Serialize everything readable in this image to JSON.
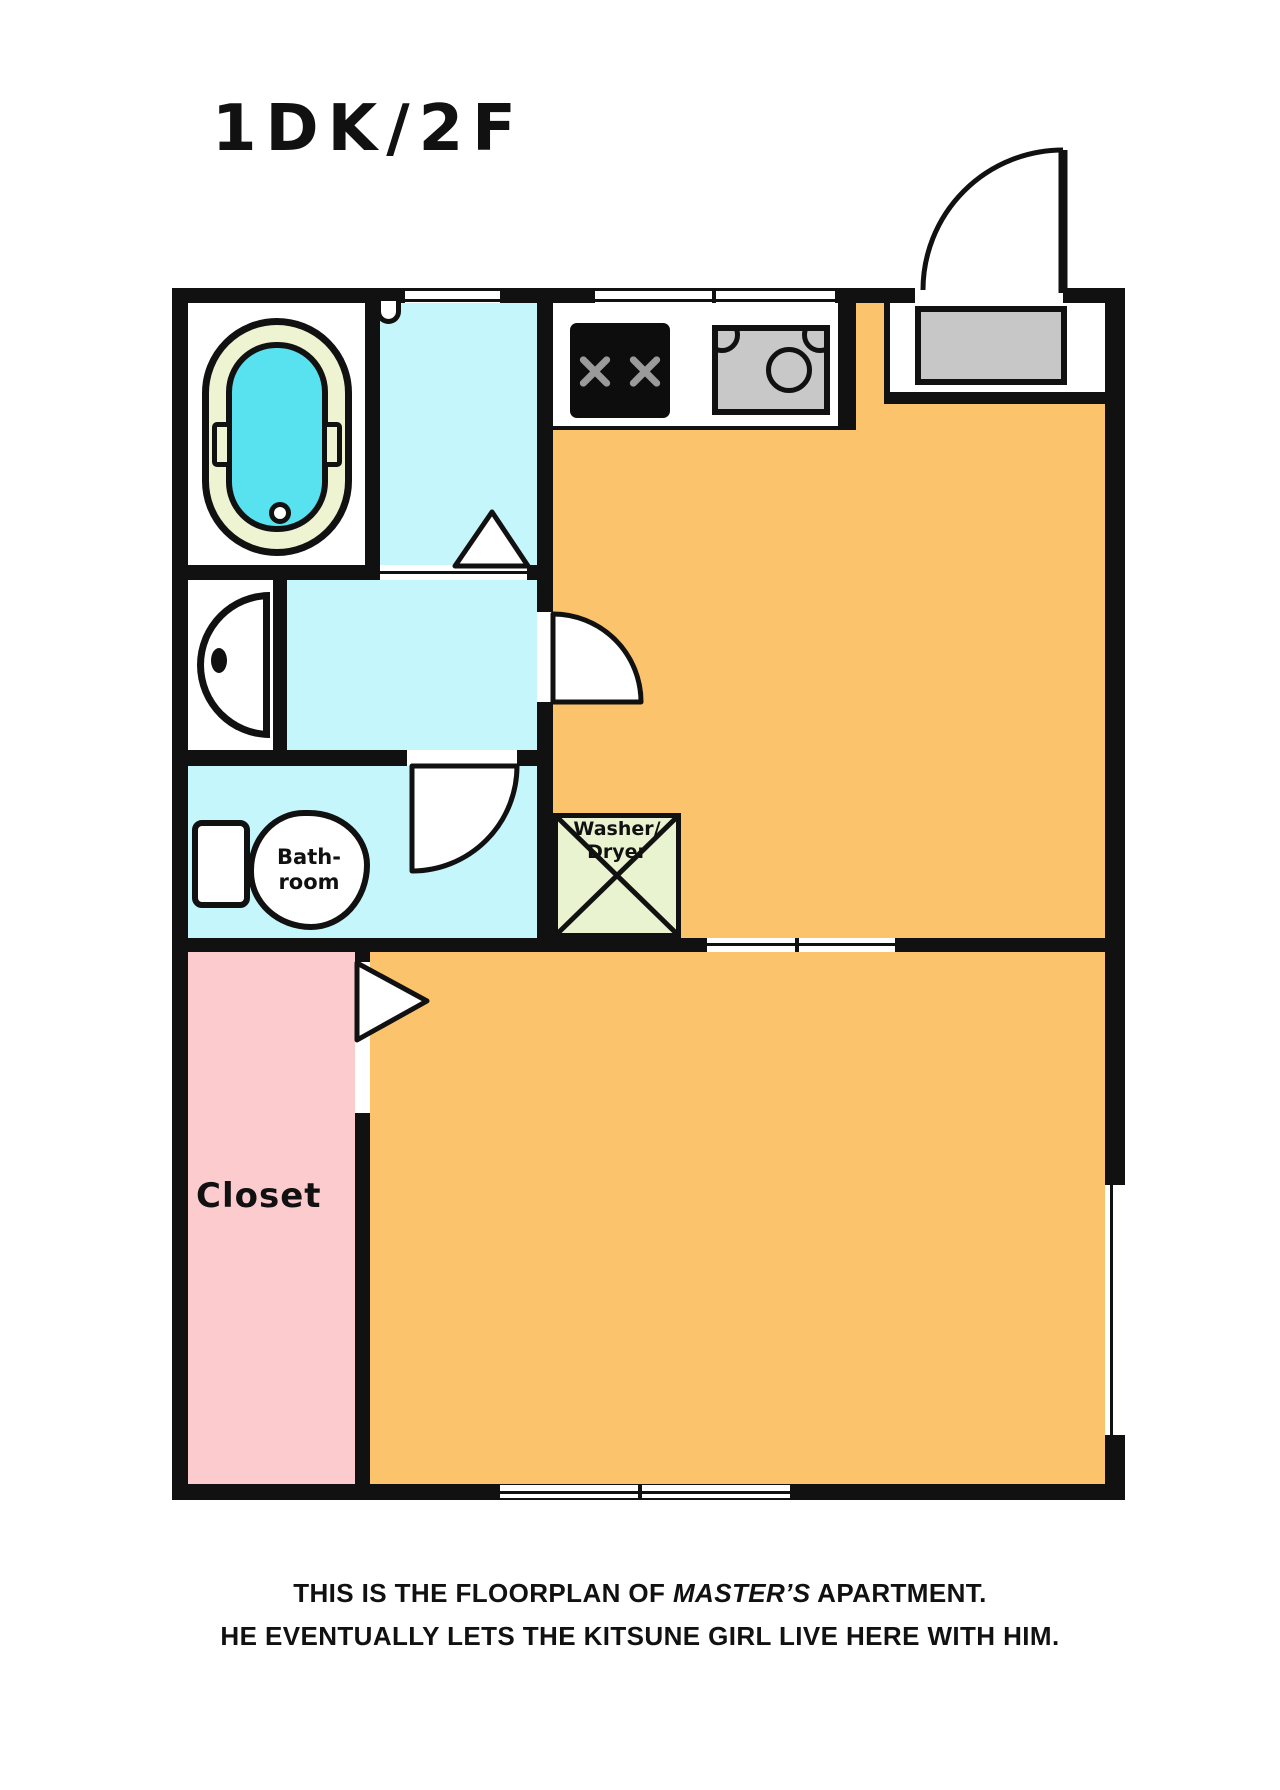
{
  "title": "1DK/2F",
  "labels": {
    "closet": "Closet",
    "bathroom_line1": "Bath-",
    "bathroom_line2": "room",
    "washer_line1": "Washer/",
    "washer_line2": "Dryer"
  },
  "caption": {
    "line1_pre": "THIS IS THE FLOORPLAN OF ",
    "line1_em": "MASTER’S",
    "line1_post": " APARTMENT.",
    "line2": "HE EVENTUALLY LETS THE KITSUNE GIRL LIVE HERE WITH HIM."
  },
  "colors": {
    "wall": "#111111",
    "washroom_cyan": "#c5f6fb",
    "room_orange": "#fbc36c",
    "closet_pink": "#fbcbce",
    "tub_rim_cream": "#eef3d1",
    "tub_water_cyan": "#58e1ef",
    "washer_green": "#eaf3cf",
    "mat_gray": "#c7c7c7",
    "stove_black": "#0d0d0d",
    "burner_gray": "#9a9a9a",
    "sink_gray": "#c8c8c8"
  }
}
